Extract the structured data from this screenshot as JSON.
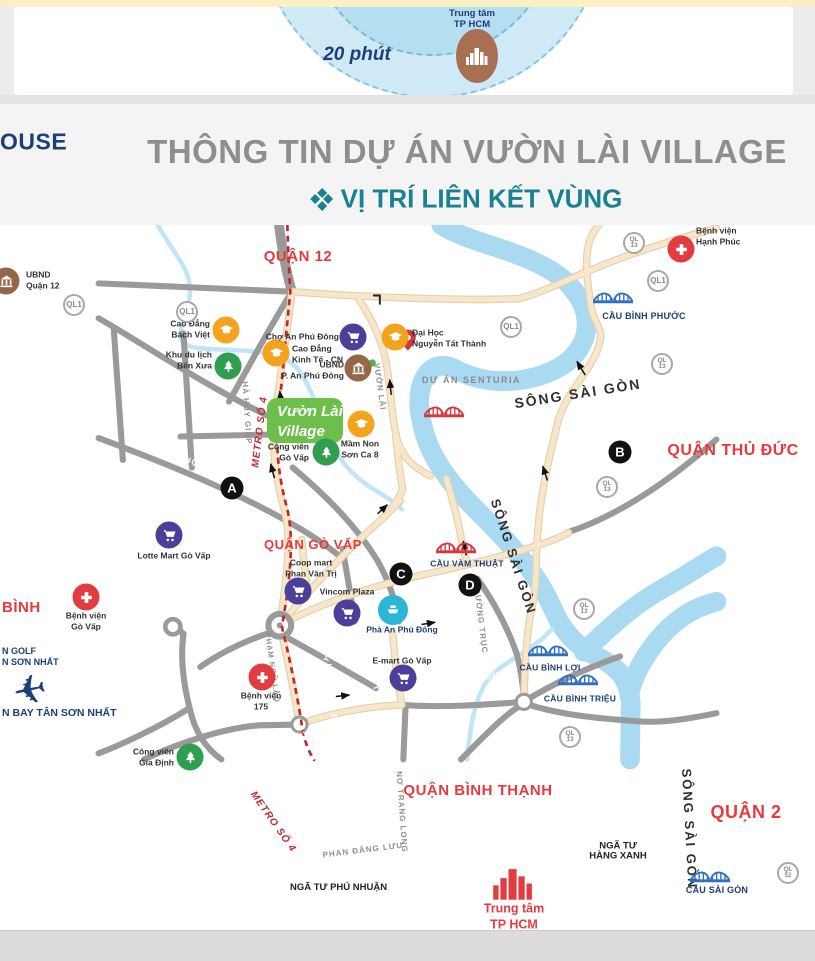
{
  "top_diagram": {
    "minutes": "20 phút",
    "center_label": "Trung tâm\nTP HCM",
    "center_icon": "city-skyline-icon"
  },
  "header": {
    "logo": "OUSE",
    "title": "THÔNG TIN DỰ ÁN VƯỜN LÀI VILLAGE",
    "subtitle_icon": "diamond-cluster-icon",
    "subtitle": "VỊ TRÍ LIÊN KẾT VÙNG"
  },
  "map": {
    "project": {
      "name": "Vườn Lài\nVillage"
    },
    "plane": {
      "x": 30,
      "y": 691
    },
    "labels": [
      {
        "t": "QUẬN 12",
        "x": 298,
        "y": 257,
        "r": 0,
        "c": "district",
        "fs": 15
      },
      {
        "t": "QUẬN THỦ ĐỨC",
        "x": 733,
        "y": 451,
        "r": 0,
        "c": "district",
        "fs": 16
      },
      {
        "t": "QUẬN GÒ VẤP",
        "x": 313,
        "y": 545,
        "r": 0,
        "c": "district",
        "fs": 13
      },
      {
        "t": "QUẬN BÌNH THẠNH",
        "x": 478,
        "y": 791,
        "r": 0,
        "c": "district",
        "fs": 15
      },
      {
        "t": "QUẬN 2",
        "x": 746,
        "y": 813,
        "r": 0,
        "c": "district",
        "fs": 18
      },
      {
        "t": "BÌNH",
        "x": 2,
        "y": 608,
        "r": 0,
        "c": "district",
        "fs": 15,
        "a": "w"
      },
      {
        "t": "SÔNG SÀI GÒN",
        "x": 578,
        "y": 394,
        "r": -9,
        "c": "river",
        "fs": 14
      },
      {
        "t": "SÔNG SÀI GÒN",
        "x": 513,
        "y": 557,
        "r": 72,
        "c": "river",
        "fs": 13
      },
      {
        "t": "SÔNG SÀI GÒN",
        "x": 689,
        "y": 829,
        "r": 87,
        "c": "river",
        "fs": 13
      },
      {
        "t": "LÊ ĐỨC THỌ",
        "x": 50,
        "y": 374,
        "r": 31,
        "c": "roadw",
        "fs": 8
      },
      {
        "t": "LÊ ĐỨC THỌ",
        "x": 170,
        "y": 454,
        "r": 21,
        "c": "roadw",
        "fs": 8
      },
      {
        "t": "LÊ VĂN THỌ",
        "x": 25,
        "y": 470,
        "r": 86,
        "c": "roadw",
        "fs": 8
      },
      {
        "t": "THỐNG NHẤT",
        "x": 117,
        "y": 487,
        "r": 84,
        "c": "roadw",
        "fs": 8
      },
      {
        "t": "QUANG TRUNG",
        "x": 26,
        "y": 537,
        "r": 20,
        "c": "roadw",
        "fs": 8
      },
      {
        "t": "QUANG TRUNG",
        "x": 150,
        "y": 580,
        "r": 24,
        "c": "roadw",
        "fs": 8
      },
      {
        "t": "NGUYỄN VĂN LƯỢNG",
        "x": 178,
        "y": 501,
        "r": 0,
        "c": "roadw",
        "fs": 7.5
      },
      {
        "t": "PHAN VĂN TRỊ",
        "x": 369,
        "y": 669,
        "r": 72,
        "c": "roadw",
        "fs": 7.5
      },
      {
        "t": "LÊ QUANG ĐỊNH",
        "x": 332,
        "y": 700,
        "r": 84,
        "c": "roadw",
        "fs": 7.5
      },
      {
        "t": "NGUYỄN KIỆM",
        "x": 241,
        "y": 688,
        "r": 84,
        "c": "roadw",
        "fs": 8
      },
      {
        "t": "NGUYỄN XÍ",
        "x": 541,
        "y": 741,
        "r": 58,
        "c": "roadw",
        "fs": 8
      },
      {
        "t": "ỤNG VĂN KHIÊM",
        "x": 621,
        "y": 813,
        "r": 35,
        "c": "roadw",
        "fs": 8
      },
      {
        "t": "ĐIỆN BIÊN PHỦ",
        "x": 613,
        "y": 872,
        "r": 13,
        "c": "roadw",
        "fs": 8
      },
      {
        "t": "HOÀNG VĂN THỤ",
        "x": 206,
        "y": 884,
        "r": -4,
        "c": "roadw",
        "fs": 8
      },
      {
        "t": "TRƯỜNG SƠN",
        "x": 115,
        "y": 793,
        "r": 86,
        "c": "roadw",
        "fs": 8
      },
      {
        "t": "NGUYỄN OANH",
        "x": 244,
        "y": 601,
        "r": 73,
        "c": "roadw",
        "fs": 8
      },
      {
        "t": "NGUYỄN THÁI SƠN",
        "x": 341,
        "y": 643,
        "r": -51,
        "c": "roadw",
        "fs": 8
      },
      {
        "t": "PHẠM VĂN ĐỒNG",
        "x": 313,
        "y": 733,
        "r": -13,
        "c": "roadw",
        "fs": 8
      },
      {
        "t": "PHẠM VĂN ĐỒNG",
        "x": 466,
        "y": 682,
        "r": -11,
        "c": "roadw",
        "fs": 8
      },
      {
        "t": "HÀ HUY GIÁP",
        "x": 246,
        "y": 413,
        "r": 86,
        "c": "roadb",
        "fs": 8
      },
      {
        "t": "VƯỜN LÀI",
        "x": 379,
        "y": 387,
        "r": 82,
        "c": "roadb",
        "fs": 8
      },
      {
        "t": "PHẠM NGŨ LÃO",
        "x": 272,
        "y": 668,
        "r": 82,
        "c": "roadb",
        "fs": 7.5
      },
      {
        "t": "ĐƯỜNG TRỤC",
        "x": 480,
        "y": 621,
        "r": 83,
        "c": "roadb",
        "fs": 8
      },
      {
        "t": "PHAN ĐĂNG LƯU",
        "x": 363,
        "y": 851,
        "r": -7,
        "c": "roadb",
        "fs": 8
      },
      {
        "t": "NƠ TRANG LONG",
        "x": 401,
        "y": 812,
        "r": 86,
        "c": "roadb",
        "fs": 8
      },
      {
        "t": "CẦU BÌNH PHƯỚC",
        "x": 644,
        "y": 317,
        "r": 0,
        "c": "bridgelbl",
        "fs": 9
      },
      {
        "t": "CẦU VÀM THUẬT",
        "x": 467,
        "y": 564,
        "r": 0,
        "c": "bridgelbl",
        "fs": 8.5
      },
      {
        "t": "CẦU BÌNH LỢI",
        "x": 550,
        "y": 668,
        "r": 0,
        "c": "bridgelbl",
        "fs": 8.5
      },
      {
        "t": "CẦU BÌNH TRIỆU",
        "x": 580,
        "y": 699,
        "r": 0,
        "c": "bridgelbl",
        "fs": 8.5
      },
      {
        "t": "CẦU SÀI GÒN",
        "x": 717,
        "y": 891,
        "r": 0,
        "c": "bridgelbl",
        "fs": 9
      },
      {
        "t": "NGÃ TƯ PHÚ NHUẬN",
        "x": 290,
        "y": 888,
        "r": 0,
        "c": "junction",
        "fs": 9.5,
        "a": "w"
      },
      {
        "t": "NGÃ TƯ\nHÀNG XANH",
        "x": 618,
        "y": 852,
        "r": 0,
        "c": "junction",
        "fs": 9.5
      },
      {
        "t": "METRO SỐ 4",
        "x": 260,
        "y": 432,
        "r": -83,
        "c": "metro",
        "fs": 10
      },
      {
        "t": "METRO SỐ 4",
        "x": 273,
        "y": 822,
        "r": 55,
        "c": "metro",
        "fs": 10
      },
      {
        "t": "DỰ ÁN SENTURIA",
        "x": 422,
        "y": 381,
        "r": 0,
        "c": "senturia",
        "fs": 9,
        "a": "w"
      },
      {
        "t": "N GOLF",
        "x": 2,
        "y": 652,
        "r": 0,
        "c": "navy",
        "fs": 9,
        "a": "w"
      },
      {
        "t": "N SƠN NHẤT",
        "x": 2,
        "y": 663,
        "r": 0,
        "c": "navy",
        "fs": 9,
        "a": "w"
      },
      {
        "t": "N BAY TÂN SƠN NHẤT",
        "x": 2,
        "y": 714,
        "r": 0,
        "c": "navy",
        "fs": 10.5,
        "a": "w"
      }
    ],
    "pois": [
      {
        "icon": "cap",
        "col": "#f3a41e",
        "x": 226,
        "y": 330,
        "label": "Cao Đẳng\nBách Việt",
        "lx": 210,
        "ly": 329,
        "al": "right"
      },
      {
        "icon": "cap",
        "col": "#f3a41e",
        "x": 276,
        "y": 353,
        "label": "Cao Đẳng\nKinh Tế - CN",
        "lx": 292,
        "ly": 354,
        "al": "left"
      },
      {
        "icon": "cap",
        "col": "#f3a41e",
        "x": 395,
        "y": 337,
        "label": "Đại Học\nNguyễn Tất Thành",
        "lx": 412,
        "ly": 338,
        "al": "left"
      },
      {
        "icon": "cap",
        "col": "#f3a41e",
        "x": 361,
        "y": 424,
        "label": "Mầm Non\nSơn Ca 8",
        "lx": 360,
        "ly": 449,
        "al": "center"
      },
      {
        "icon": "tree",
        "col": "#2f9e4f",
        "x": 228,
        "y": 366,
        "label": "Khu du lịch\nBến Xưa",
        "lx": 212,
        "ly": 360,
        "al": "right"
      },
      {
        "icon": "tree",
        "col": "#2f9e4f",
        "x": 326,
        "y": 452,
        "label": "Công viên\nGò Vấp",
        "lx": 309,
        "ly": 452,
        "al": "right"
      },
      {
        "icon": "tree",
        "col": "#2f9e4f",
        "x": 190,
        "y": 757,
        "label": "Công viên\nGia Định",
        "lx": 174,
        "ly": 757,
        "al": "right"
      },
      {
        "icon": "cart",
        "col": "#4c3f99",
        "x": 353,
        "y": 337,
        "label": "Chợ An Phú Đông",
        "lx": 339,
        "ly": 337,
        "al": "right"
      },
      {
        "icon": "cart",
        "col": "#4c3f99",
        "x": 169,
        "y": 535,
        "label": "Lotte Mart Gò Vấp",
        "lx": 174,
        "ly": 556,
        "al": "center"
      },
      {
        "icon": "cart",
        "col": "#4c3f99",
        "x": 298,
        "y": 591,
        "label": "Coop mart\nPhan Văn Trị",
        "lx": 311,
        "ly": 568,
        "al": "center"
      },
      {
        "icon": "cart",
        "col": "#4c3f99",
        "x": 347,
        "y": 613,
        "label": "Vincom Plaza",
        "lx": 347,
        "ly": 592,
        "al": "center"
      },
      {
        "icon": "cart",
        "col": "#4c3f99",
        "x": 403,
        "y": 678,
        "label": "E-mart Gò Vấp",
        "lx": 402,
        "ly": 661,
        "al": "center"
      },
      {
        "icon": "cross",
        "col": "#e23c41",
        "x": 86,
        "y": 597,
        "label": "Bệnh viện\nGò Vấp",
        "lx": 86,
        "ly": 621,
        "al": "center"
      },
      {
        "icon": "cross",
        "col": "#e23c41",
        "x": 262,
        "y": 677,
        "label": "Bệnh viện\n175",
        "lx": 261,
        "ly": 701,
        "al": "center"
      },
      {
        "icon": "cross",
        "col": "#e23c41",
        "x": 681,
        "y": 249,
        "label": "Bệnh viện\nHạnh Phúc",
        "lx": 696,
        "ly": 236,
        "al": "left"
      },
      {
        "icon": "bank",
        "col": "#96664a",
        "x": 6,
        "y": 281,
        "label": "UBND\nQuận 12",
        "lx": 26,
        "ly": 280,
        "al": "left"
      },
      {
        "icon": "bank",
        "col": "#96664a",
        "x": 358,
        "y": 368,
        "label": "UBND\nP. An Phú Đông",
        "lx": 344,
        "ly": 370,
        "al": "right"
      },
      {
        "icon": "ferry",
        "col": "#2ab7d6",
        "x": 393,
        "y": 610,
        "label": "Phà An Phú Đông",
        "lx": 402,
        "ly": 630,
        "al": "center",
        "lc": "#1d3e78"
      },
      {
        "icon": "hcm",
        "col": "#e23c41",
        "x": 513,
        "y": 886,
        "label": "Trung tâm\nTP HCM",
        "lx": 514,
        "ly": 917,
        "al": "center",
        "lc": "#e23c41",
        "lfs": 12.5
      }
    ],
    "badges": [
      {
        "t": "QL1",
        "x": 74,
        "y": 305
      },
      {
        "t": "QL1",
        "x": 187,
        "y": 312
      },
      {
        "t": "QL1",
        "x": 511,
        "y": 327
      },
      {
        "t": "QL1",
        "x": 658,
        "y": 281
      },
      {
        "t": "QL\n13",
        "x": 634,
        "y": 243
      },
      {
        "t": "QL\n13",
        "x": 662,
        "y": 364
      },
      {
        "t": "QL\n13",
        "x": 607,
        "y": 487
      },
      {
        "t": "QL\n13",
        "x": 584,
        "y": 609
      },
      {
        "t": "QL\n13",
        "x": 570,
        "y": 737
      },
      {
        "t": "QL\n52",
        "x": 788,
        "y": 873
      }
    ],
    "markers": [
      {
        "t": "A",
        "x": 232,
        "y": 488
      },
      {
        "t": "B",
        "x": 620,
        "y": 452
      },
      {
        "t": "C",
        "x": 401,
        "y": 574
      },
      {
        "t": "D",
        "x": 470,
        "y": 585
      }
    ],
    "bridges": [
      {
        "c": "#2e6fc0",
        "x": 613,
        "y": 297
      },
      {
        "c": "#d6363c",
        "x": 444,
        "y": 411
      },
      {
        "c": "#d6363c",
        "x": 456,
        "y": 547
      },
      {
        "c": "#2e6fc0",
        "x": 548,
        "y": 650
      },
      {
        "c": "#2e6fc0",
        "x": 578,
        "y": 679
      },
      {
        "c": "#2e6fc0",
        "x": 710,
        "y": 876
      }
    ]
  },
  "colors": {
    "accent_teal": "#19818f",
    "title_gray": "#8e8e8e",
    "navy": "#1d3e78",
    "district_red": "#e8393d",
    "metro_red": "#c4262c",
    "road_gray": "#9a9a9a",
    "road_beige": "#f2dfc2",
    "river_blue": "#a9daf2",
    "project_green": "#6cbf4a"
  }
}
